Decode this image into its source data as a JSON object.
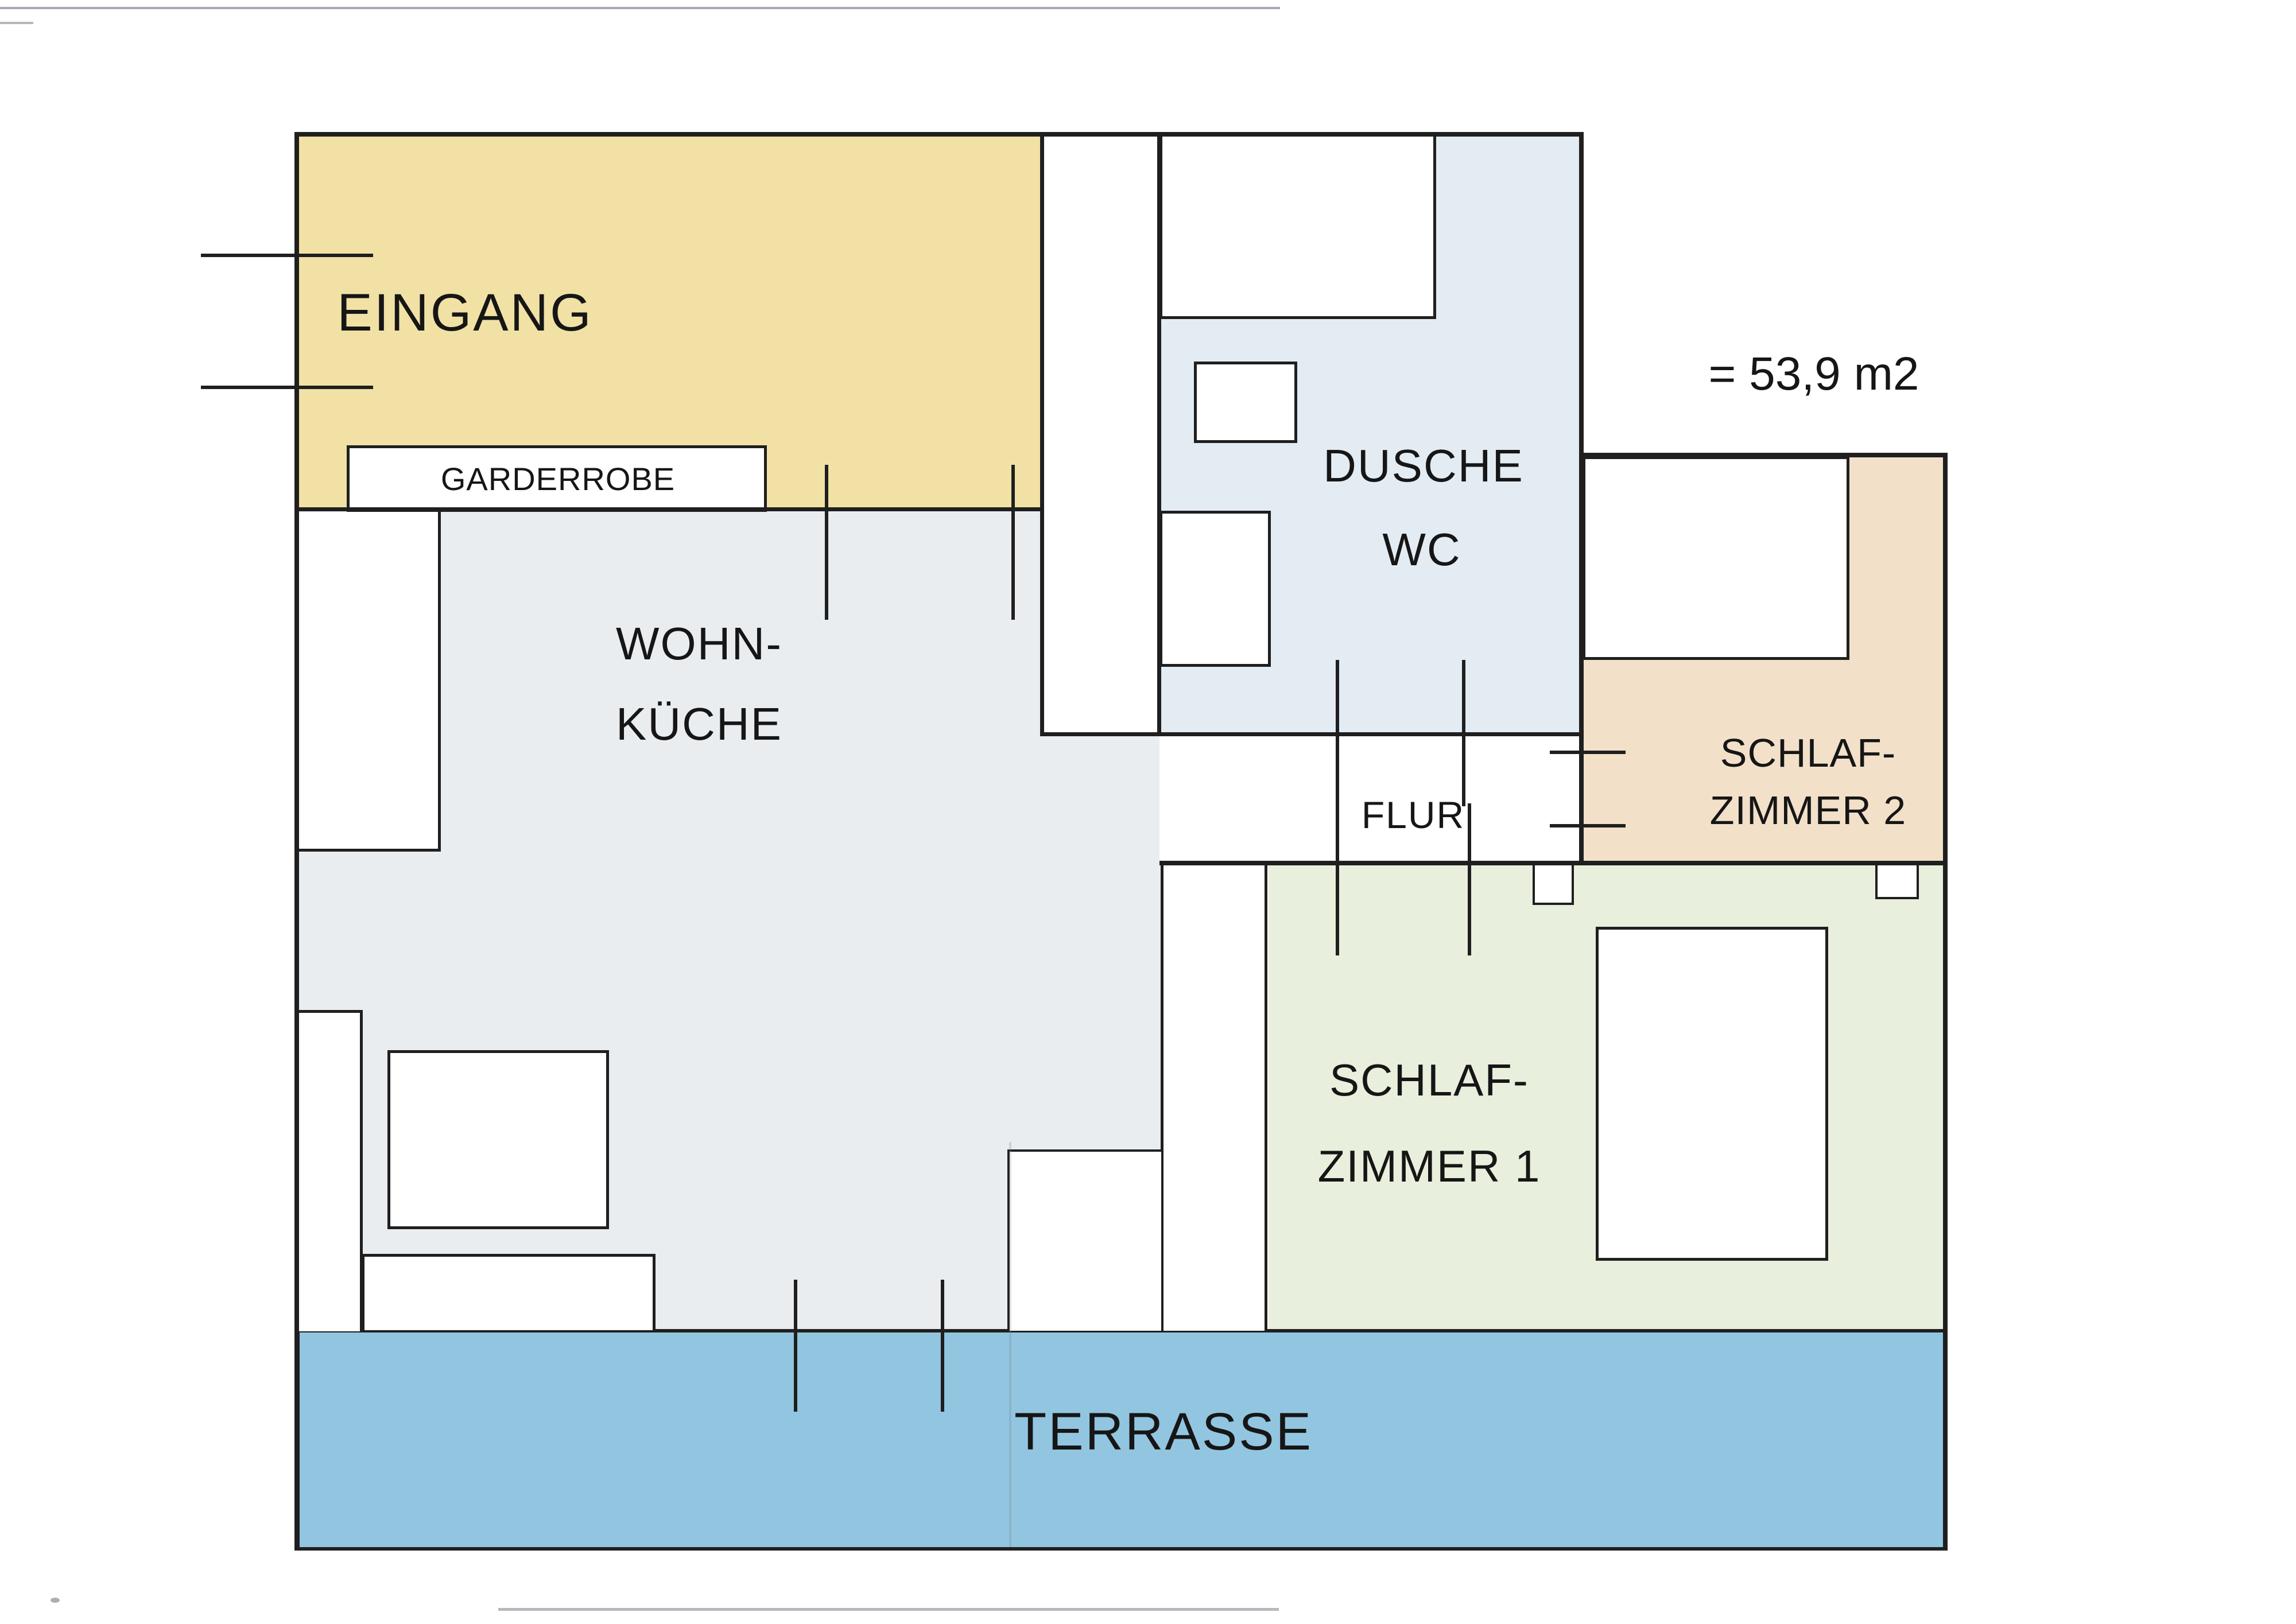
{
  "plan": {
    "area_label": "= 53,9 m2",
    "wall_color": "#1F1F1F",
    "rooms": {
      "eingang": {
        "label": "EINGANG",
        "color": "#F2E1A5"
      },
      "garderobe": {
        "label": "GARDERROBE",
        "color": "#FFFFFF"
      },
      "dusche_wc": {
        "label_line1": "DUSCHE",
        "label_line2": "WC",
        "color": "#E3EBF3"
      },
      "wohnkueche": {
        "label_line1": "WOHN-",
        "label_line2": "KÜCHE",
        "color": "#E9EDF0"
      },
      "flur": {
        "label": "FLUR",
        "color": "#FFFFFF"
      },
      "schlafzimmer2": {
        "label_line1": "SCHLAF-",
        "label_line2": "ZIMMER 2",
        "color": "#F2E0C9"
      },
      "schlafzimmer1": {
        "label_line1": "SCHLAF-",
        "label_line2": "ZIMMER 1",
        "color": "#E8EFDC"
      },
      "terrasse": {
        "label": "TERRASSE",
        "color": "#92C5E0"
      }
    }
  }
}
